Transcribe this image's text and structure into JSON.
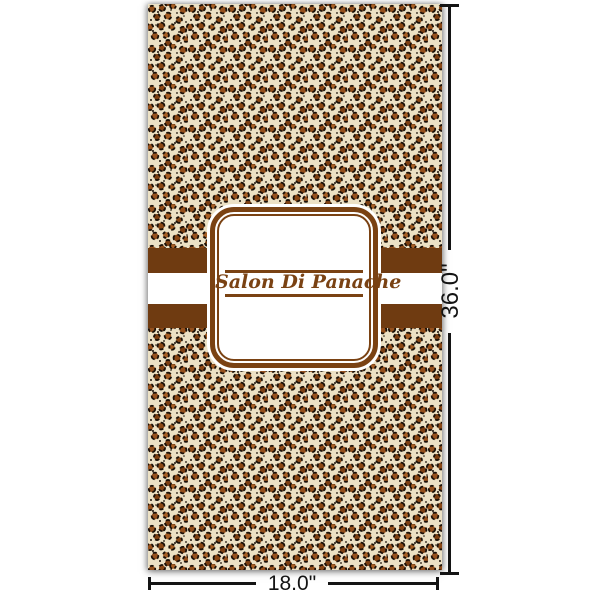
{
  "product": {
    "name": "leopard-print-banner-preview",
    "pattern_name": "leopard-print",
    "label_text": "Salon Di Panache"
  },
  "dimensions": {
    "width_label": "18.0\"",
    "height_label": "36.0\""
  },
  "colors": {
    "stripe_brown": "#6f3b11",
    "label_brown": "#7a4213",
    "pattern_cream": "#ece1c5",
    "spot_dark": "#1a1008",
    "spot_rust": "#96511d",
    "dimension_line": "#141414",
    "page_background": "#ffffff"
  }
}
